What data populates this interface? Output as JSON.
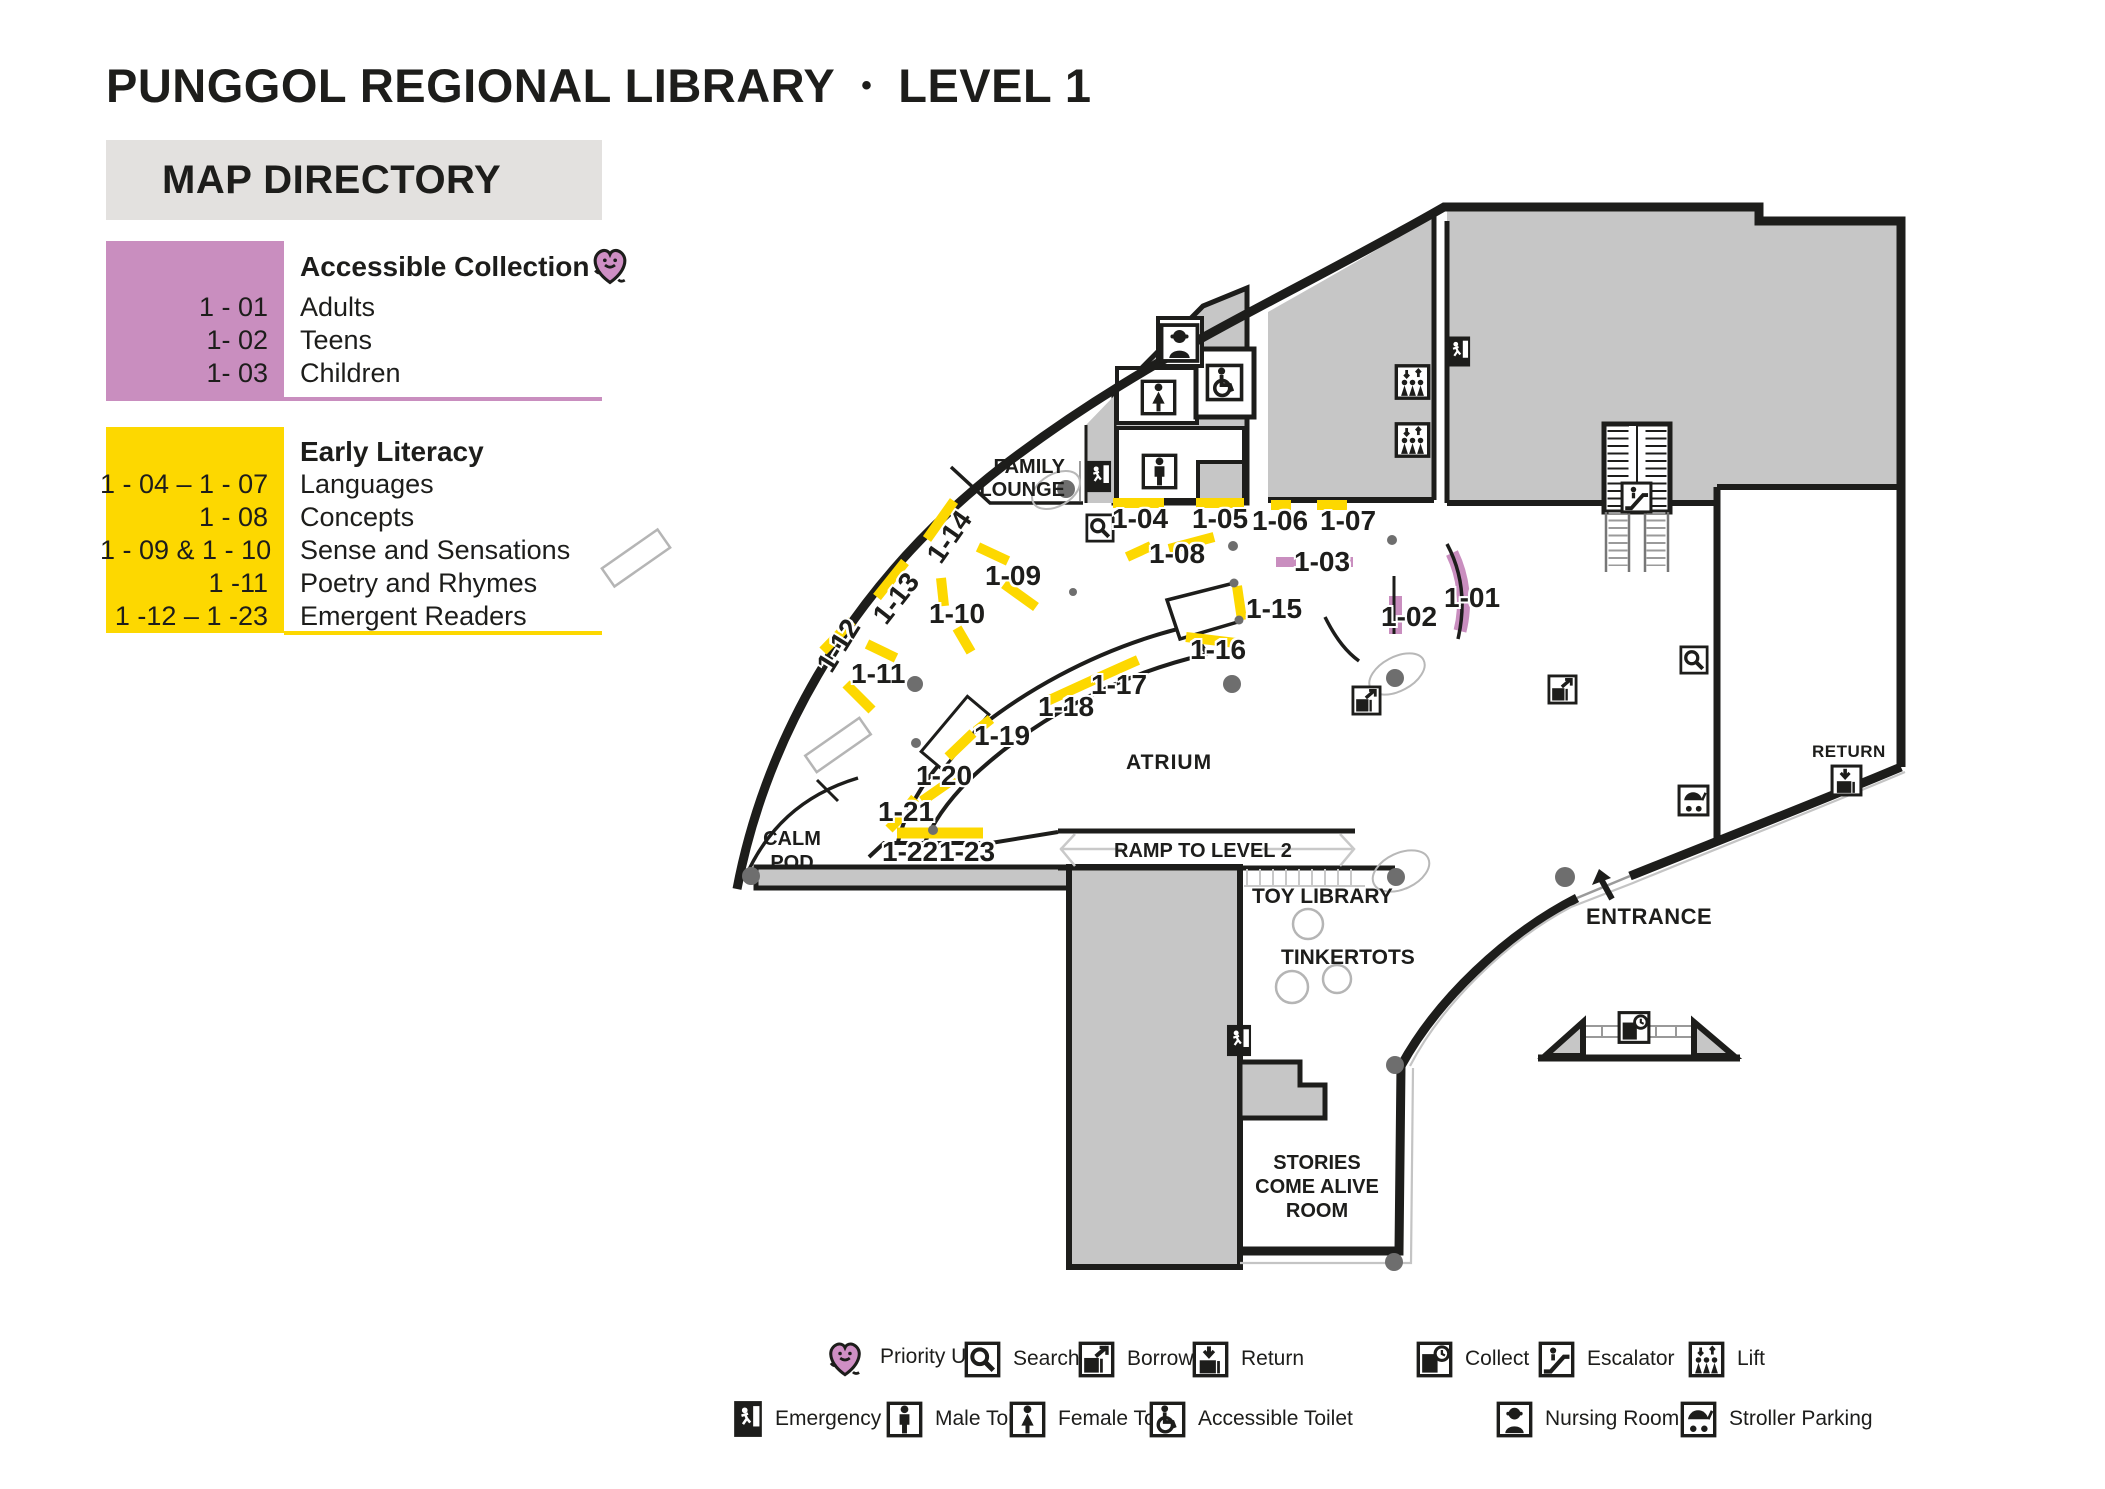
{
  "title": {
    "library": "PUNGGOL REGIONAL LIBRARY",
    "bullet": "•",
    "level": "LEVEL 1"
  },
  "directory": {
    "header": "MAP DIRECTORY",
    "accessible": {
      "heading": "Accessible Collection",
      "rows": [
        {
          "code": "1 - 01",
          "label": "Adults"
        },
        {
          "code": "1- 02",
          "label": "Teens"
        },
        {
          "code": "1- 03",
          "label": "Children"
        }
      ]
    },
    "early": {
      "heading": "Early Literacy",
      "rows": [
        {
          "code": "1 - 04 – 1 - 07",
          "label": "Languages"
        },
        {
          "code": "1 - 08",
          "label": "Concepts"
        },
        {
          "code": "1 - 09 & 1 - 10",
          "label": "Sense and Sensations"
        },
        {
          "code": "1 -11",
          "label": "Poetry and Rhymes"
        },
        {
          "code": "1 -12 – 1 -23",
          "label": "Emergent Readers"
        }
      ]
    }
  },
  "map": {
    "areas": {
      "family_lounge_line1": "FAMILY",
      "family_lounge_line2": "LOUNGE",
      "atrium": "ATRIUM",
      "calm_pod_line1": "CALM",
      "calm_pod_line2": "POD",
      "ramp": "RAMP TO LEVEL 2",
      "toy_library": "TOY LIBRARY",
      "tinkertots": "TINKERTOTS",
      "stories_line1": "STORIES",
      "stories_line2": "COME ALIVE",
      "stories_line3": "ROOM",
      "entrance": "ENTRANCE",
      "return": "RETURN"
    },
    "shelves": {
      "s01": "1-01",
      "s02": "1-02",
      "s03": "1-03",
      "s04": "1-04",
      "s05": "1-05",
      "s06": "1-06",
      "s07": "1-07",
      "s08": "1-08",
      "s09": "1-09",
      "s10": "1-10",
      "s11": "1-11",
      "s12": "1-12",
      "s13": "1-13",
      "s14": "1-14",
      "s15": "1-15",
      "s16": "1-16",
      "s17": "1-17",
      "s18": "1-18",
      "s19": "1-19",
      "s20": "1-20",
      "s21": "1-21",
      "s22": "1-22",
      "s23": "1-23"
    }
  },
  "legend": {
    "row1": [
      {
        "icon": "priority-use-icon",
        "label": "Priority Use"
      },
      {
        "icon": "search-icon",
        "label": "Search"
      },
      {
        "icon": "borrow-icon",
        "label": "Borrow"
      },
      {
        "icon": "return-icon",
        "label": "Return"
      },
      {
        "icon": "collect-icon",
        "label": "Collect"
      },
      {
        "icon": "escalator-icon",
        "label": "Escalator"
      },
      {
        "icon": "lift-icon",
        "label": "Lift"
      }
    ],
    "row2": [
      {
        "icon": "emergency-exit-icon",
        "label": "Emergency Exit"
      },
      {
        "icon": "male-toilet-icon",
        "label": "Male Toilet"
      },
      {
        "icon": "female-toilet-icon",
        "label": "Female Toilet"
      },
      {
        "icon": "accessible-toilet-icon",
        "label": "Accessible Toilet"
      },
      {
        "icon": "nursing-room-icon",
        "label": "Nursing Room"
      },
      {
        "icon": "stroller-parking-icon",
        "label": "Stroller Parking"
      }
    ]
  },
  "colors": {
    "accessible_pink": "#c98ebf",
    "early_yellow": "#fdd800",
    "building_gray": "#c6c6c6",
    "header_gray": "#e3e1df",
    "line_black": "#1d1d1b",
    "dot_gray": "#6e6e6e"
  }
}
